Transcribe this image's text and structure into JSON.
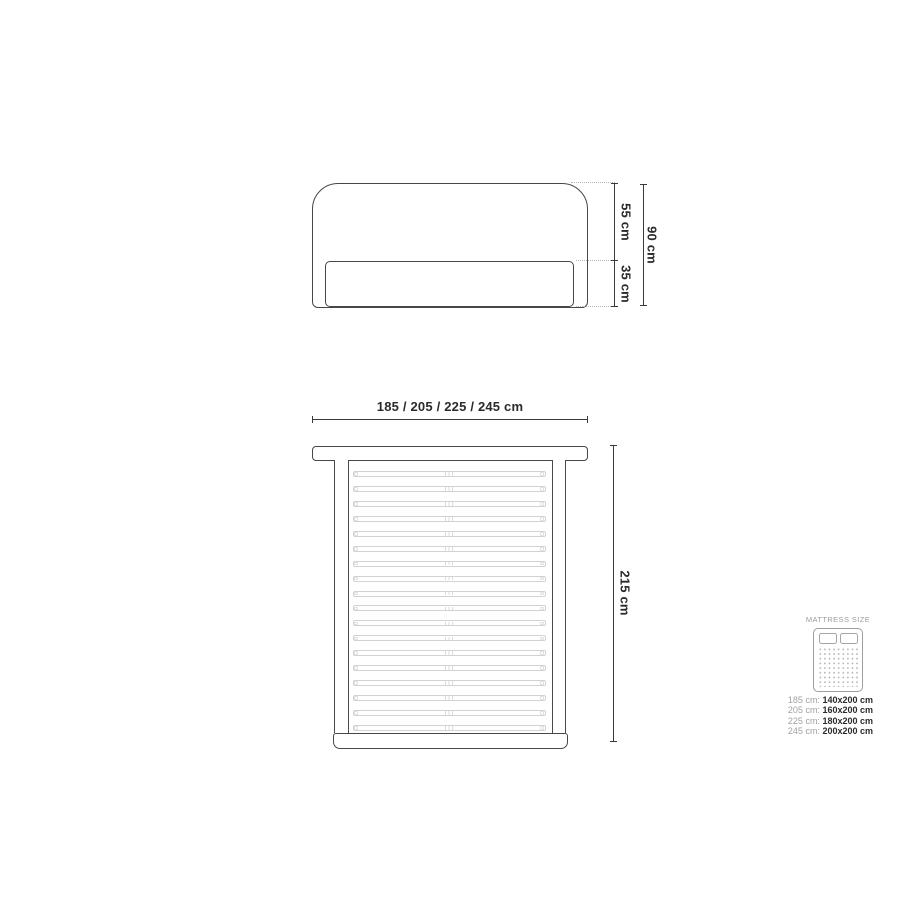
{
  "front_view": {
    "upper_height_label": "55 cm",
    "lower_height_label": "35 cm",
    "total_height_label": "90 cm"
  },
  "top_view": {
    "width_label": "185 / 205 / 225 / 245 cm",
    "length_label": "215 cm",
    "slat_count": 18
  },
  "legend": {
    "title": "MATTRESS SIZE",
    "rows": [
      {
        "bed_width": "185 cm:",
        "mattress_size": "140x200 cm"
      },
      {
        "bed_width": "205 cm:",
        "mattress_size": "160x200 cm"
      },
      {
        "bed_width": "225 cm:",
        "mattress_size": "180x200 cm"
      },
      {
        "bed_width": "245 cm:",
        "mattress_size": "200x200 cm"
      }
    ]
  },
  "colors": {
    "outline_dark": "#474747",
    "dimension_line": "#3a3a3a",
    "dotted_extension": "#b5b5b5",
    "slat_gray": "#d2d2d2",
    "text_dark": "#2b2b2b",
    "legend_gray": "#9d9d9d",
    "background": "#ffffff"
  }
}
